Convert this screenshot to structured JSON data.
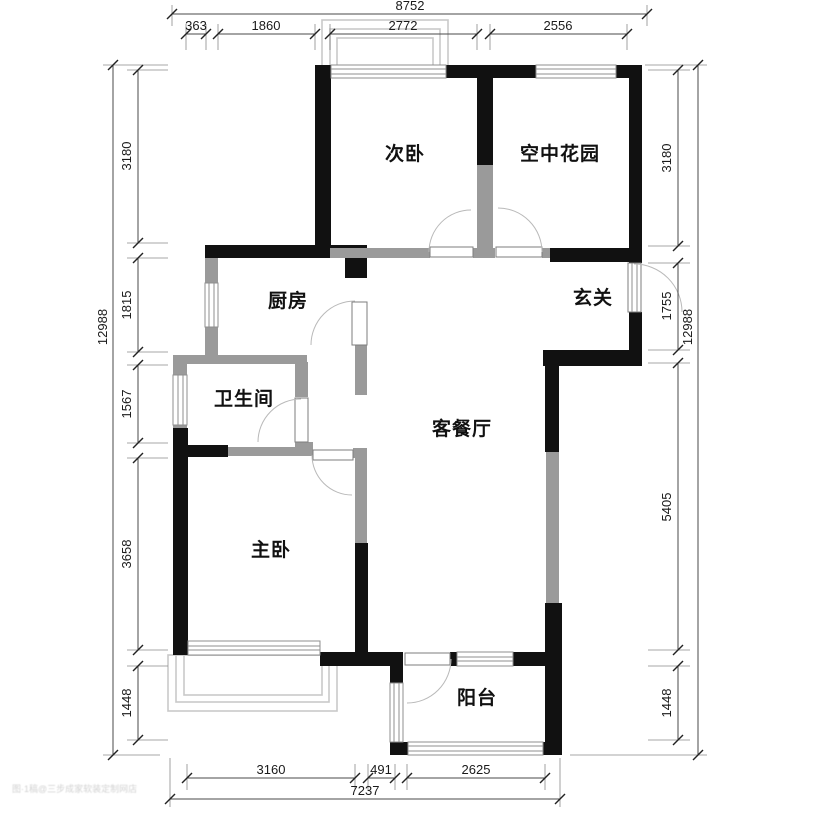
{
  "meta": {
    "type": "residential-floor-plan"
  },
  "rooms": {
    "bedroom2": "次卧",
    "sky_garden": "空中花园",
    "kitchen": "厨房",
    "foyer": "玄关",
    "bathroom": "卫生间",
    "living_dining": "客餐厅",
    "master_bedroom": "主卧",
    "balcony": "阳台"
  },
  "dimensions": {
    "top": {
      "overall": "8752",
      "segments": [
        "363",
        "1860",
        "2772",
        "2556"
      ]
    },
    "left": {
      "overall": "12988",
      "segments": [
        "3180",
        "1815",
        "1567",
        "3658",
        "1448"
      ]
    },
    "right": {
      "overall": "12988",
      "segments": [
        "3180",
        "1755",
        "5405",
        "1448"
      ]
    },
    "bottom": {
      "overall": "7237",
      "segments": [
        "3160",
        "491",
        "2625"
      ]
    }
  },
  "watermark": "图·1稿@三步成家软装定制网店",
  "colors": {
    "load_bearing_wall": "#111111",
    "partition_wall": "#9a9a9a",
    "window_frame": "#8f8f8f",
    "bay_window": "#c9c9c9",
    "dimension_line": "#4a4a4a",
    "text": "#1a1a1a",
    "background": "#ffffff"
  }
}
